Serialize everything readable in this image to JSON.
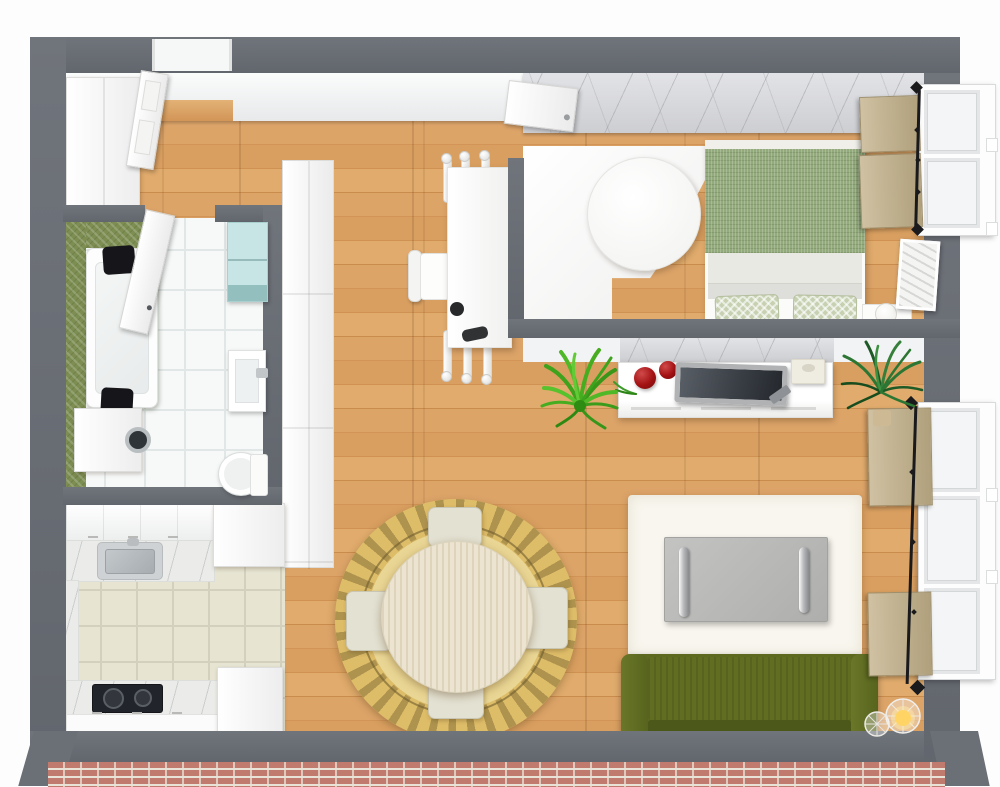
{
  "scene": {
    "title": "3D apartment floor plan, top-down view",
    "render_style": "photoreal 3D dollhouse plan",
    "walls": "slate gray",
    "flooring": "oak plank with tiled bathroom and kitchen"
  },
  "palette": {
    "wall": "#686c73",
    "wallFace": "#f1f2f3",
    "marbleAccent": "#d9dadd",
    "woodFloor": "#d79e5e",
    "kitchenTile": "#e7e5d2",
    "bathTile": "#f6f8f8",
    "greenWall": "#7d8e52",
    "teal": "#c6e5e4",
    "duvet": "#93aa7c",
    "pillow": "#c7d1b2",
    "sofa": "#5c691f",
    "rugGold": "#debd69",
    "rugWhite": "#f8f6ee",
    "tvScreen": "#3a3f46",
    "redDecor": "#a31113",
    "plantBright": "#46ab22",
    "plantDark": "#2e7d35",
    "lampGlow": "#ffd465",
    "blind": "#c3b291",
    "rod": "#1a1a1d",
    "brick": "#c17a6e"
  },
  "rooms": [
    {
      "name": "entry",
      "furniture": [
        "wardrobe",
        "entry door (open)"
      ]
    },
    {
      "name": "bathroom",
      "furniture": [
        "bathtub with two black headrests",
        "washing machine",
        "teal wall cabinet",
        "wall sink",
        "toilet",
        "door (open)",
        "green accent wall"
      ]
    },
    {
      "name": "kitchen",
      "furniture": [
        "upper cabinet run",
        "marble counter with steel sink",
        "tall cabinet",
        "marble counter with black cooktop",
        "base cabinets"
      ]
    },
    {
      "name": "living-dining",
      "furniture": [
        "round dining table",
        "4 cream chairs",
        "ornate gold round rug",
        "white rectangular table with turned legs",
        "white side chair",
        "white TV sideboard",
        "flat TV",
        "red bowls",
        "remote",
        "cream speaker box",
        "bright fern plant",
        "dark palm plant",
        "white area rug",
        "gray coffee table with chrome rails",
        "olive green sofa",
        "wire cage floor lamps",
        "window with tan roman blinds",
        "black curtain rod"
      ]
    },
    {
      "name": "bedroom",
      "furniture": [
        "marble accent wall",
        "white corner desk with round end",
        "double bed with sage duvet",
        "two patterned pillows",
        "nightstand",
        "round table lamp",
        "leaning art frame",
        "window with tan roman blinds",
        "black curtain rod",
        "door (open)"
      ]
    }
  ]
}
